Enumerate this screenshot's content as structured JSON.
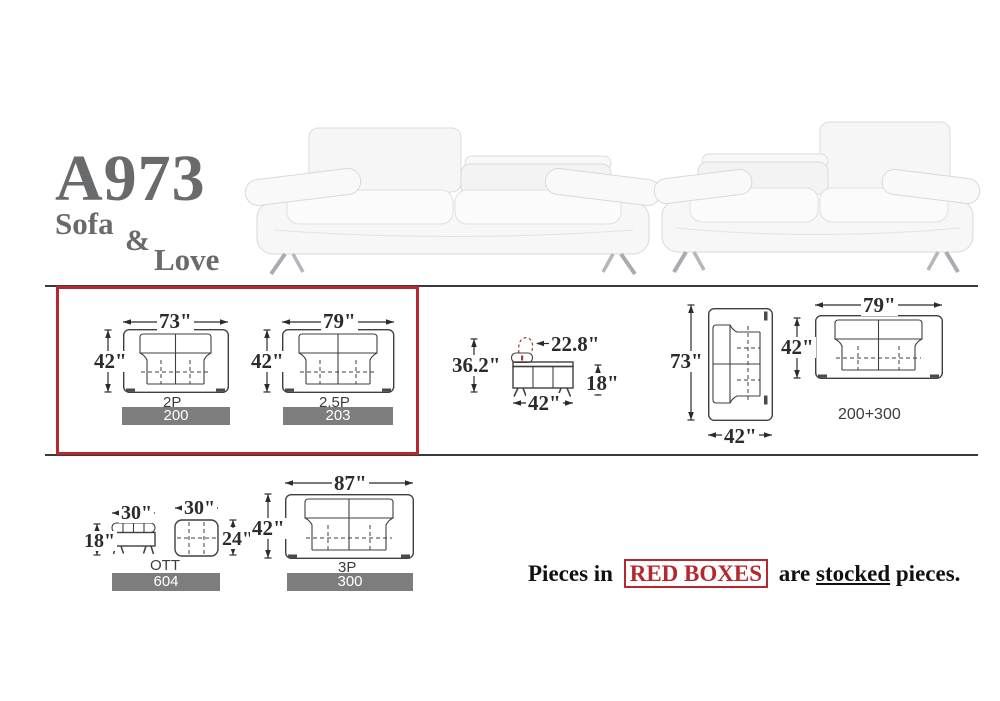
{
  "title": {
    "model": "A973",
    "word_sofa": "Sofa",
    "word_amp": "&",
    "word_love": "Love"
  },
  "colors": {
    "title_gray": "#696a6c",
    "drawing_line": "#3f3f3f",
    "dimension_text": "#2b2b2b",
    "badge_bg": "#7d7d7d",
    "badge_text": "#ffffff",
    "red_accent": "#b4282e"
  },
  "diagrams": {
    "sofa_2p": {
      "width": "73\"",
      "depth": "42\"",
      "label": "2P",
      "sku": "200"
    },
    "sofa_25p": {
      "width": "79\"",
      "depth": "42\"",
      "label": "2.5P",
      "sku": "203"
    },
    "side_profile": {
      "height": "36.2\"",
      "headrest_depth": "22.8\"",
      "seat_height": "18\"",
      "depth": "42\""
    },
    "top_rotated": {
      "length": "73\"",
      "depth": "42\""
    },
    "loveseat_top": {
      "width": "79\"",
      "depth": "42\"",
      "combo": "200+300"
    },
    "ottoman": {
      "side_width": "30\"",
      "side_height": "18\"",
      "top_width": "30\"",
      "top_depth": "24\"",
      "label": "OTT",
      "sku": "604"
    },
    "sofa_3p": {
      "width": "87\"",
      "depth": "42\"",
      "label": "3P",
      "sku": "300"
    }
  },
  "stocked_note": {
    "prefix": "Pieces in",
    "boxed": "RED BOXES",
    "middle": "are",
    "underlined": "stocked",
    "suffix": "pieces."
  }
}
